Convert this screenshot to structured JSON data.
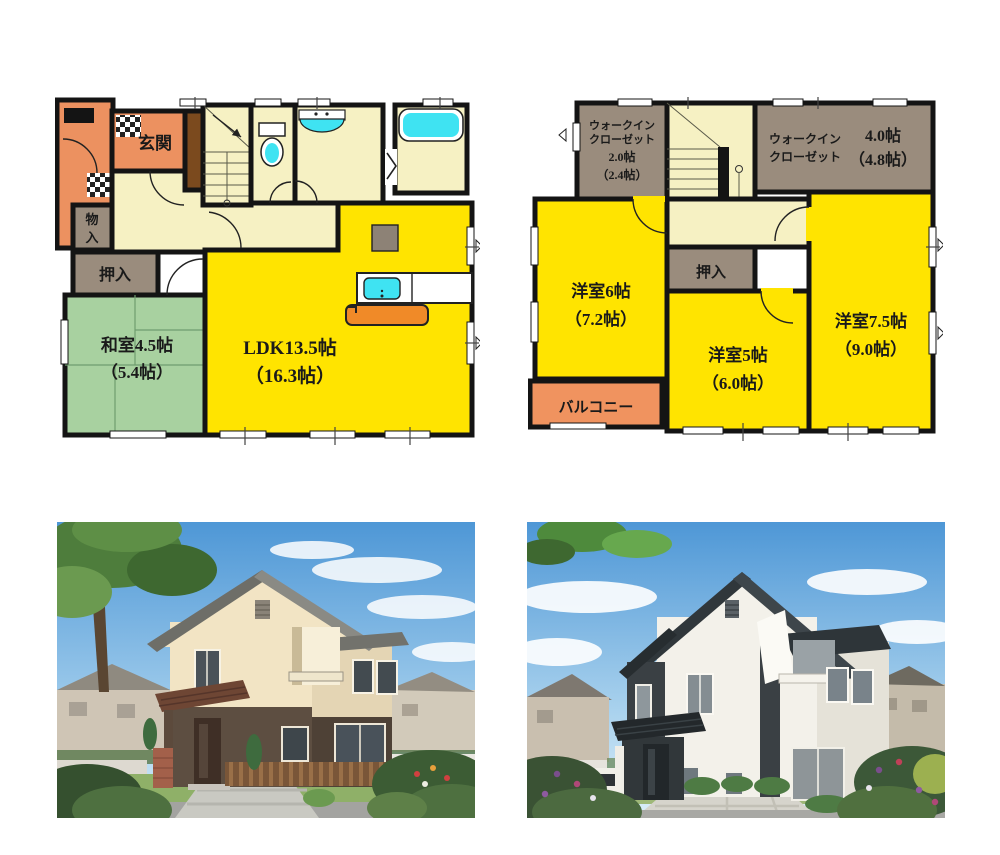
{
  "document": {
    "type": "real-estate listing image",
    "sections": [
      "first-floor-plan",
      "second-floor-plan",
      "exterior-rendering-left",
      "exterior-rendering-right"
    ]
  },
  "floor1": {
    "rooms": {
      "genkan": "玄関",
      "monoire_l1": "物",
      "monoire_l2": "入",
      "oshiire": "押入",
      "washitsu_l1": "和室4.5帖",
      "washitsu_l2": "（5.4帖）",
      "ldk_l1": "LDK13.5帖",
      "ldk_l2": "（16.3帖）"
    }
  },
  "floor2": {
    "rooms": {
      "wic_small_l1": "ウォークイン",
      "wic_small_l2": "クローゼット",
      "wic_small_l3": "2.0帖",
      "wic_small_l4": "（2.4帖）",
      "wic_large_l1": "ウォークイン",
      "wic_large_l2": "クローゼット",
      "wic_large_size1": "4.0帖",
      "wic_large_size2": "（4.8帖）",
      "yoshitsu6_l1": "洋室6帖",
      "yoshitsu6_l2": "（7.2帖）",
      "oshiire": "押入",
      "yoshitsu5_l1": "洋室5帖",
      "yoshitsu5_l2": "（6.0帖）",
      "yoshitsu75_l1": "洋室7.5帖",
      "yoshitsu75_l2": "（9.0帖）",
      "balcony": "バルコニー"
    }
  },
  "colors": {
    "wall_black": "#141414",
    "ldk_yellow": "#FFE400",
    "hall_cream": "#F6F1C3",
    "tatami_green": "#A8D1A0",
    "closet_brown": "#9A8C7D",
    "entrance_orange": "#EC9160",
    "balcony_orange": "#F0935F",
    "fixture_cyan": "#3FE3F2",
    "counter_orange": "#F08A28",
    "shoe_cabinet_brown": "#7B4A1E",
    "appliance_gray": "#8D8276",
    "house1_upper_wall": "#F2E4C4",
    "house1_lower_wall": "#5D4E41",
    "house1_roof_gray": "#8A8A84",
    "house2_wall_white": "#F3F1EA",
    "house2_accent_charcoal": "#3A4044",
    "sky_blue": "#4E97D6",
    "lawn_green": "#8FB068"
  }
}
